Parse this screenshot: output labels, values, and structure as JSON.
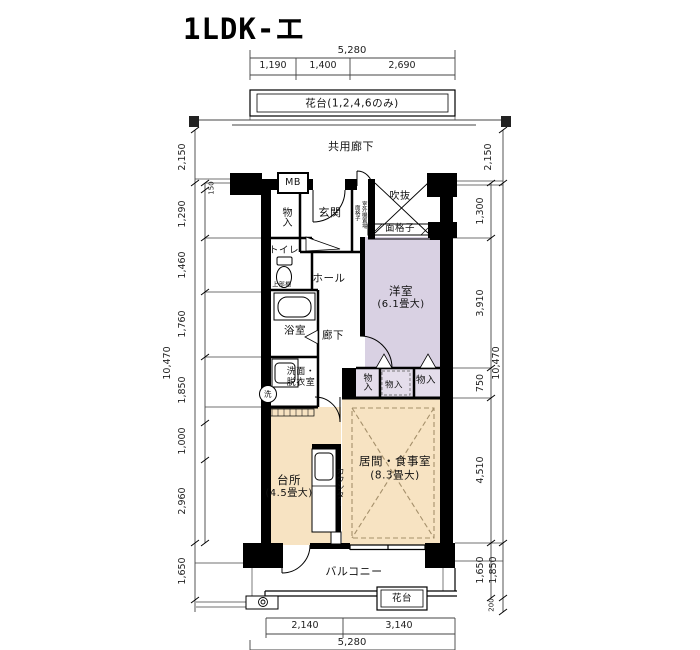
{
  "title": "1LDK-エ",
  "rooms": {
    "common_corridor": "共用廊下",
    "entrance": "玄関",
    "hall": "ホール",
    "corridor": "廊下",
    "toilet": "トイレ",
    "bath": "浴室",
    "washroom": "洗面・\n脱衣室",
    "western_room": {
      "name": "洋室",
      "size": "(6.1畳大)"
    },
    "living_dining": {
      "name": "居間・食事室",
      "size": "(8.3畳大)"
    },
    "kitchen": {
      "name": "台所",
      "size": "(4.5畳大)"
    },
    "balcony": "バルコニー",
    "void": "吹抜"
  },
  "features": {
    "meter_box": "MB",
    "closet_entrance": "物入",
    "closet_a": "物入",
    "closet_b": "物入",
    "closet_c": "物入",
    "upper_shelf": "上部棚",
    "washer": "洗",
    "counter": "カウンター",
    "grille": "面格子",
    "grille_side": "面格子",
    "outdoor_unit": "室外機置場",
    "flower_stand_top": "花台(1,2,4,6のみ)",
    "flower_stand_bottom": "花台"
  },
  "dimensions": {
    "top": {
      "total": "5,280",
      "segments": [
        "1,190",
        "1,400",
        "2,690"
      ]
    },
    "bottom": {
      "total": "5,280",
      "segments": [
        "2,140",
        "3,140"
      ]
    },
    "left": {
      "overall": "10,470",
      "top": "2,150",
      "segments": [
        "150",
        "1,290",
        "1,460",
        "1,760",
        "1,850",
        "1,000",
        "2,960"
      ],
      "bottom": "1,650"
    },
    "right": {
      "overall": "10,470",
      "top": "2,150",
      "segments": [
        "1,300",
        "3,910",
        "750",
        "4,510"
      ],
      "bottom_inner": "1,650",
      "bottom_outer": "1,850",
      "bottom_edge": "200"
    }
  },
  "colors": {
    "wall": "#000000",
    "western_room": "#d9d1e3",
    "ldk": "#f7e3c2",
    "closet_strip": "#e4ddeb",
    "dash": "#a5906b"
  }
}
